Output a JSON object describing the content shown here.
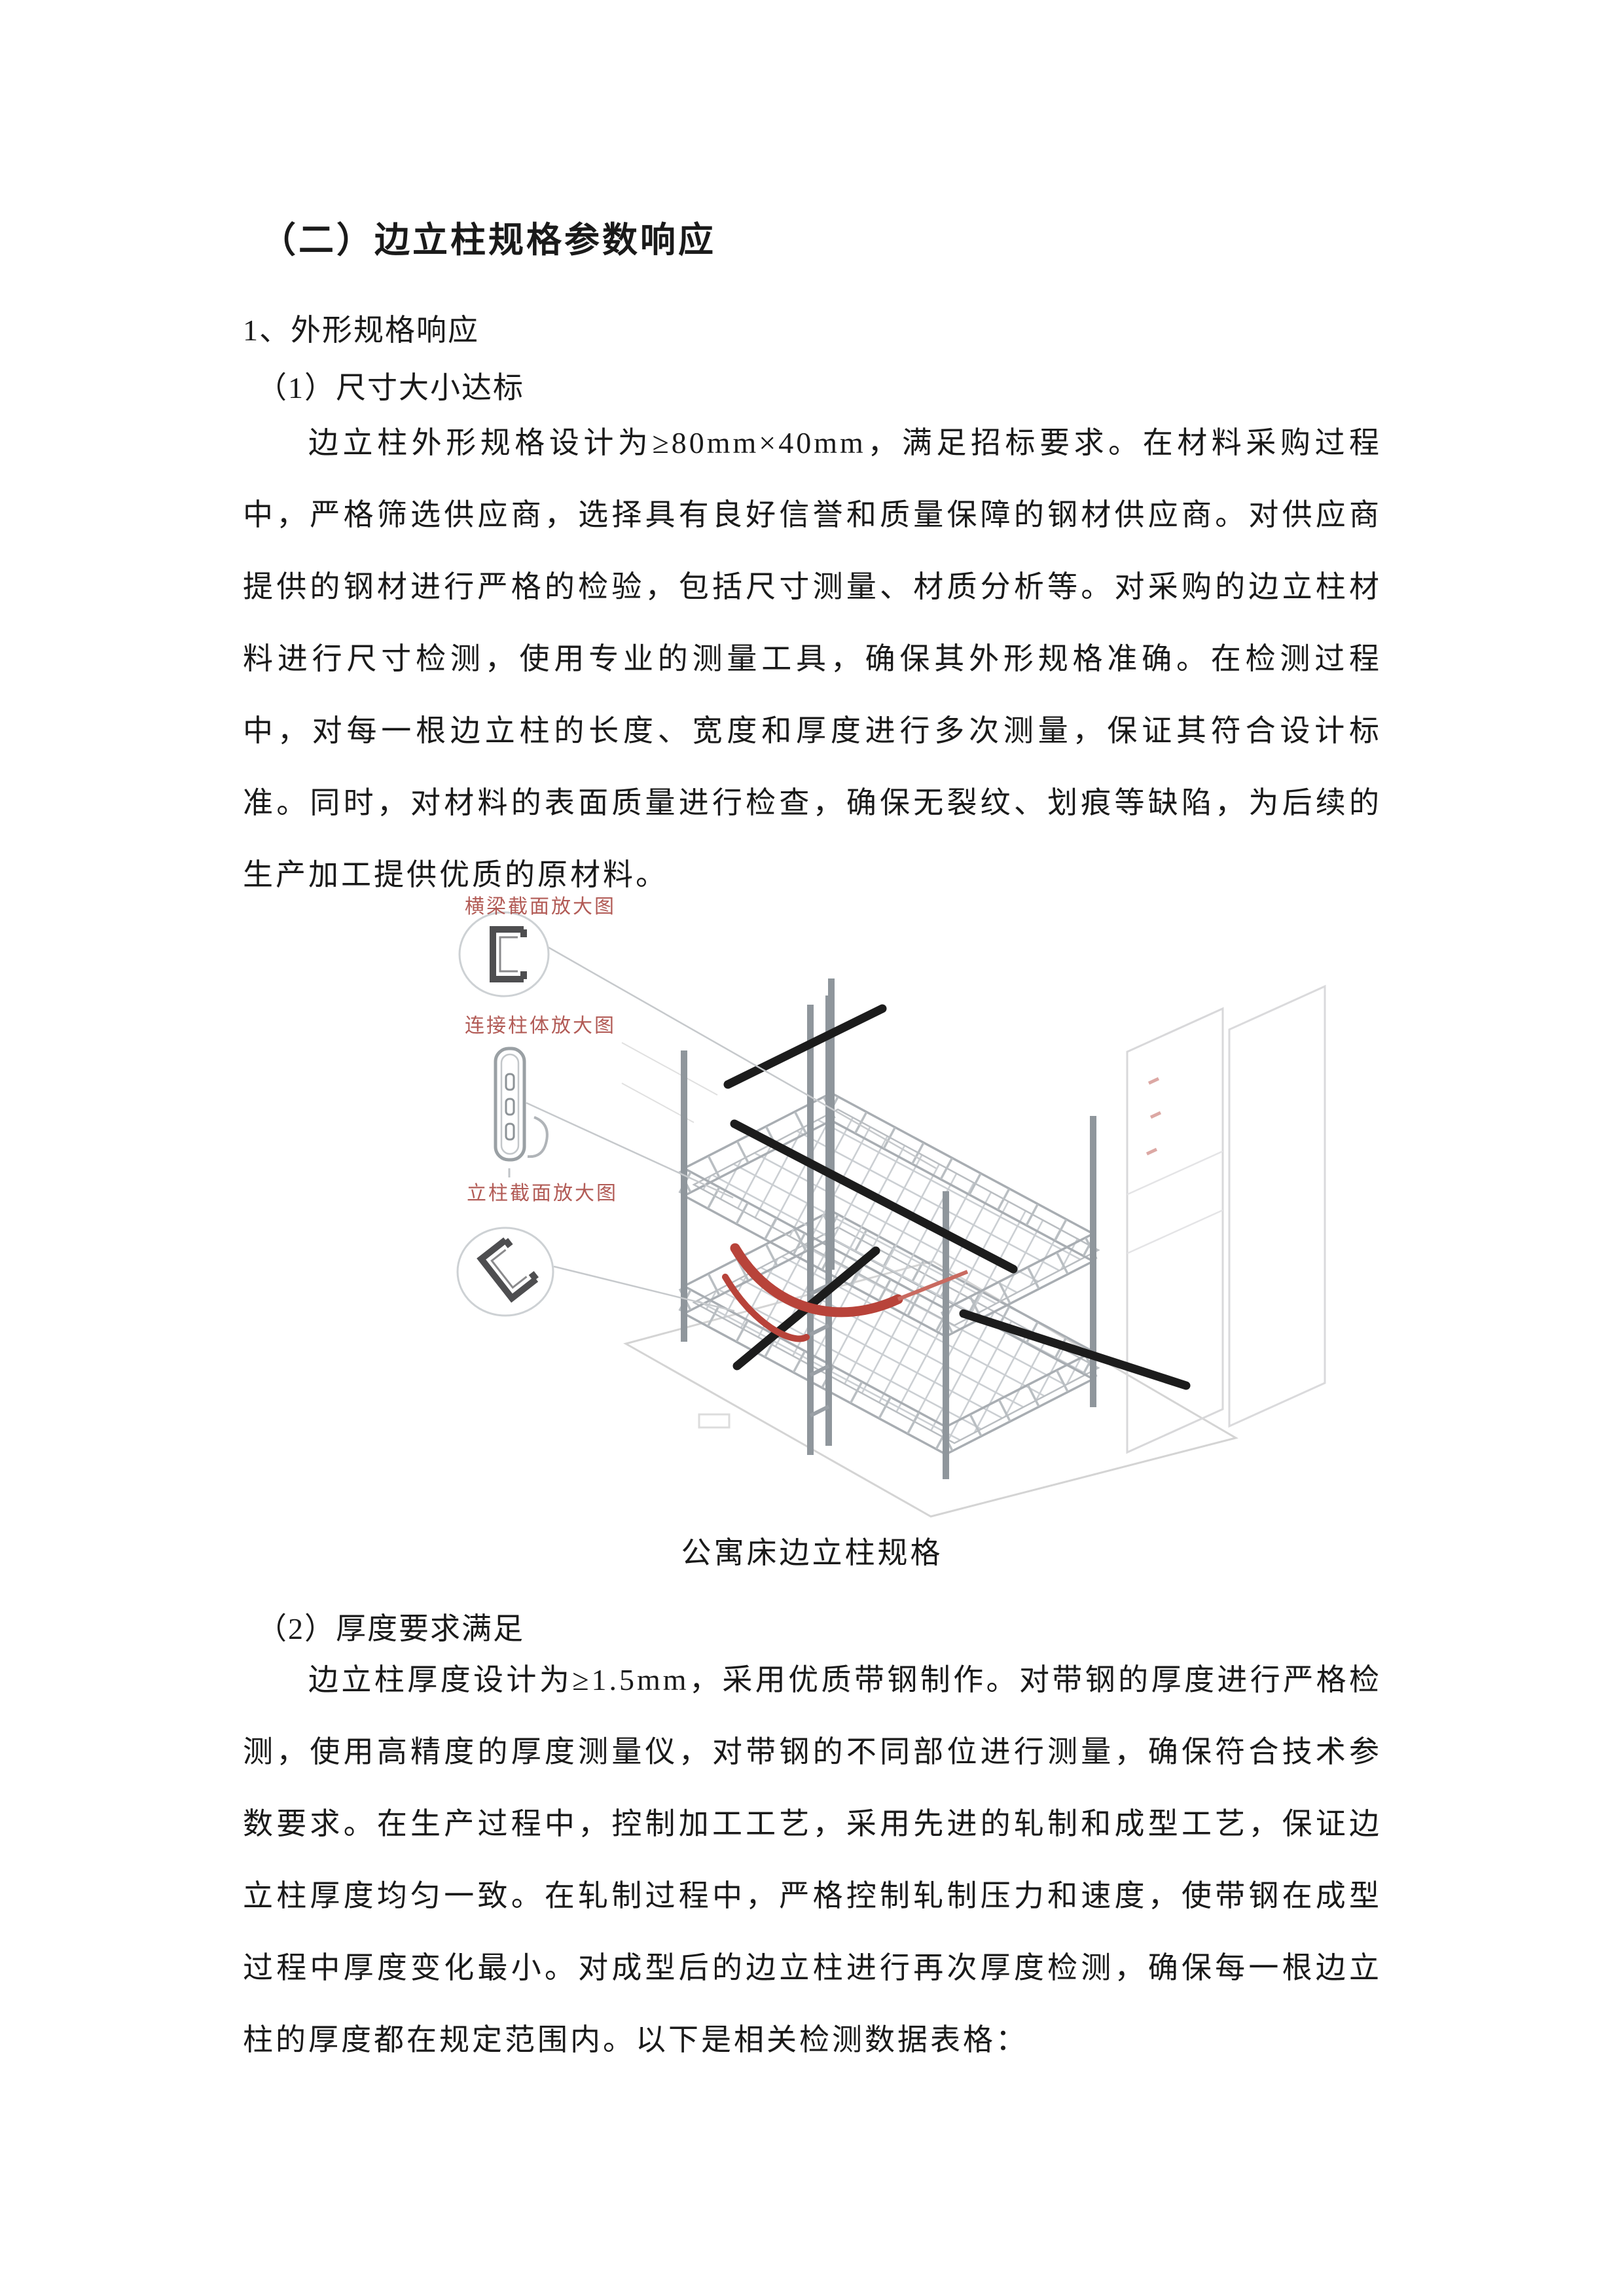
{
  "page": {
    "heading_l1": "（二）边立柱规格参数响应",
    "heading_l2": "1、外形规格响应",
    "heading_l3a": "（1）尺寸大小达标",
    "paragraph_1": "边立柱外形规格设计为≥80mm×40mm，满足招标要求。在材料采购过程中，严格筛选供应商，选择具有良好信誉和质量保障的钢材供应商。对供应商提供的钢材进行严格的检验，包括尺寸测量、材质分析等。对采购的边立柱材料进行尺寸检测，使用专业的测量工具，确保其外形规格准确。在检测过程中，对每一根边立柱的长度、宽度和厚度进行多次测量，保证其符合设计标准。同时，对材料的表面质量进行检查，确保无裂纹、划痕等缺陷，为后续的生产加工提供优质的原材料。",
    "figure": {
      "caption": "公寓床边立柱规格",
      "callout_labels": [
        "横梁截面放大图",
        "连接柱体放大图",
        "立柱截面放大图"
      ],
      "accent_color": "#a8453f",
      "highlight_color": "#b8433a",
      "line_color": "#a8adb2"
    },
    "heading_l3b": "（2）厚度要求满足",
    "paragraph_2": "边立柱厚度设计为≥1.5mm，采用优质带钢制作。对带钢的厚度进行严格检测，使用高精度的厚度测量仪，对带钢的不同部位进行测量，确保符合技术参数要求。在生产过程中，控制加工工艺，采用先进的轧制和成型工艺，保证边立柱厚度均匀一致。在轧制过程中，严格控制轧制压力和速度，使带钢在成型过程中厚度变化最小。对成型后的边立柱进行再次厚度检测，确保每一根边立柱的厚度都在规定范围内。以下是相关检测数据表格："
  }
}
